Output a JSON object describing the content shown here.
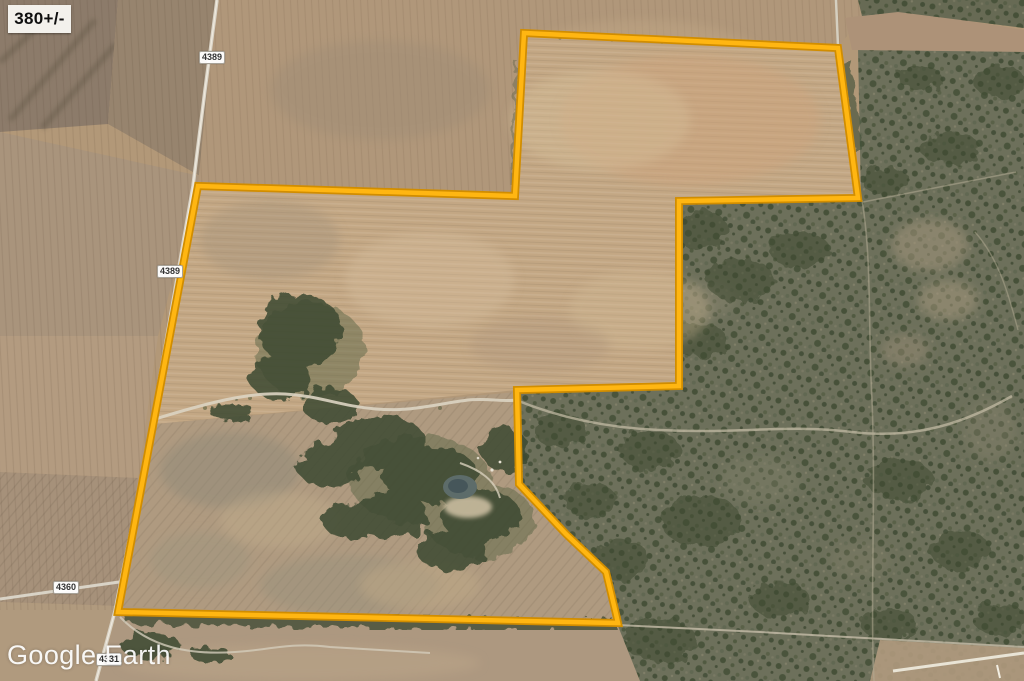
{
  "map": {
    "acreage_label": "380+/-",
    "watermark": "Google Earth",
    "road_labels": [
      {
        "text": "4389"
      },
      {
        "text": "4389"
      },
      {
        "text": "4360"
      },
      {
        "text": "4331"
      }
    ],
    "boundary": {
      "points": "198,186 515,196 524,33 838,48 858,198 679,201 679,386 517,390 519,484 566,534 606,572 616,614 618,623 118,612",
      "color": "#ffb612",
      "outline_color": "#d18d00"
    }
  }
}
